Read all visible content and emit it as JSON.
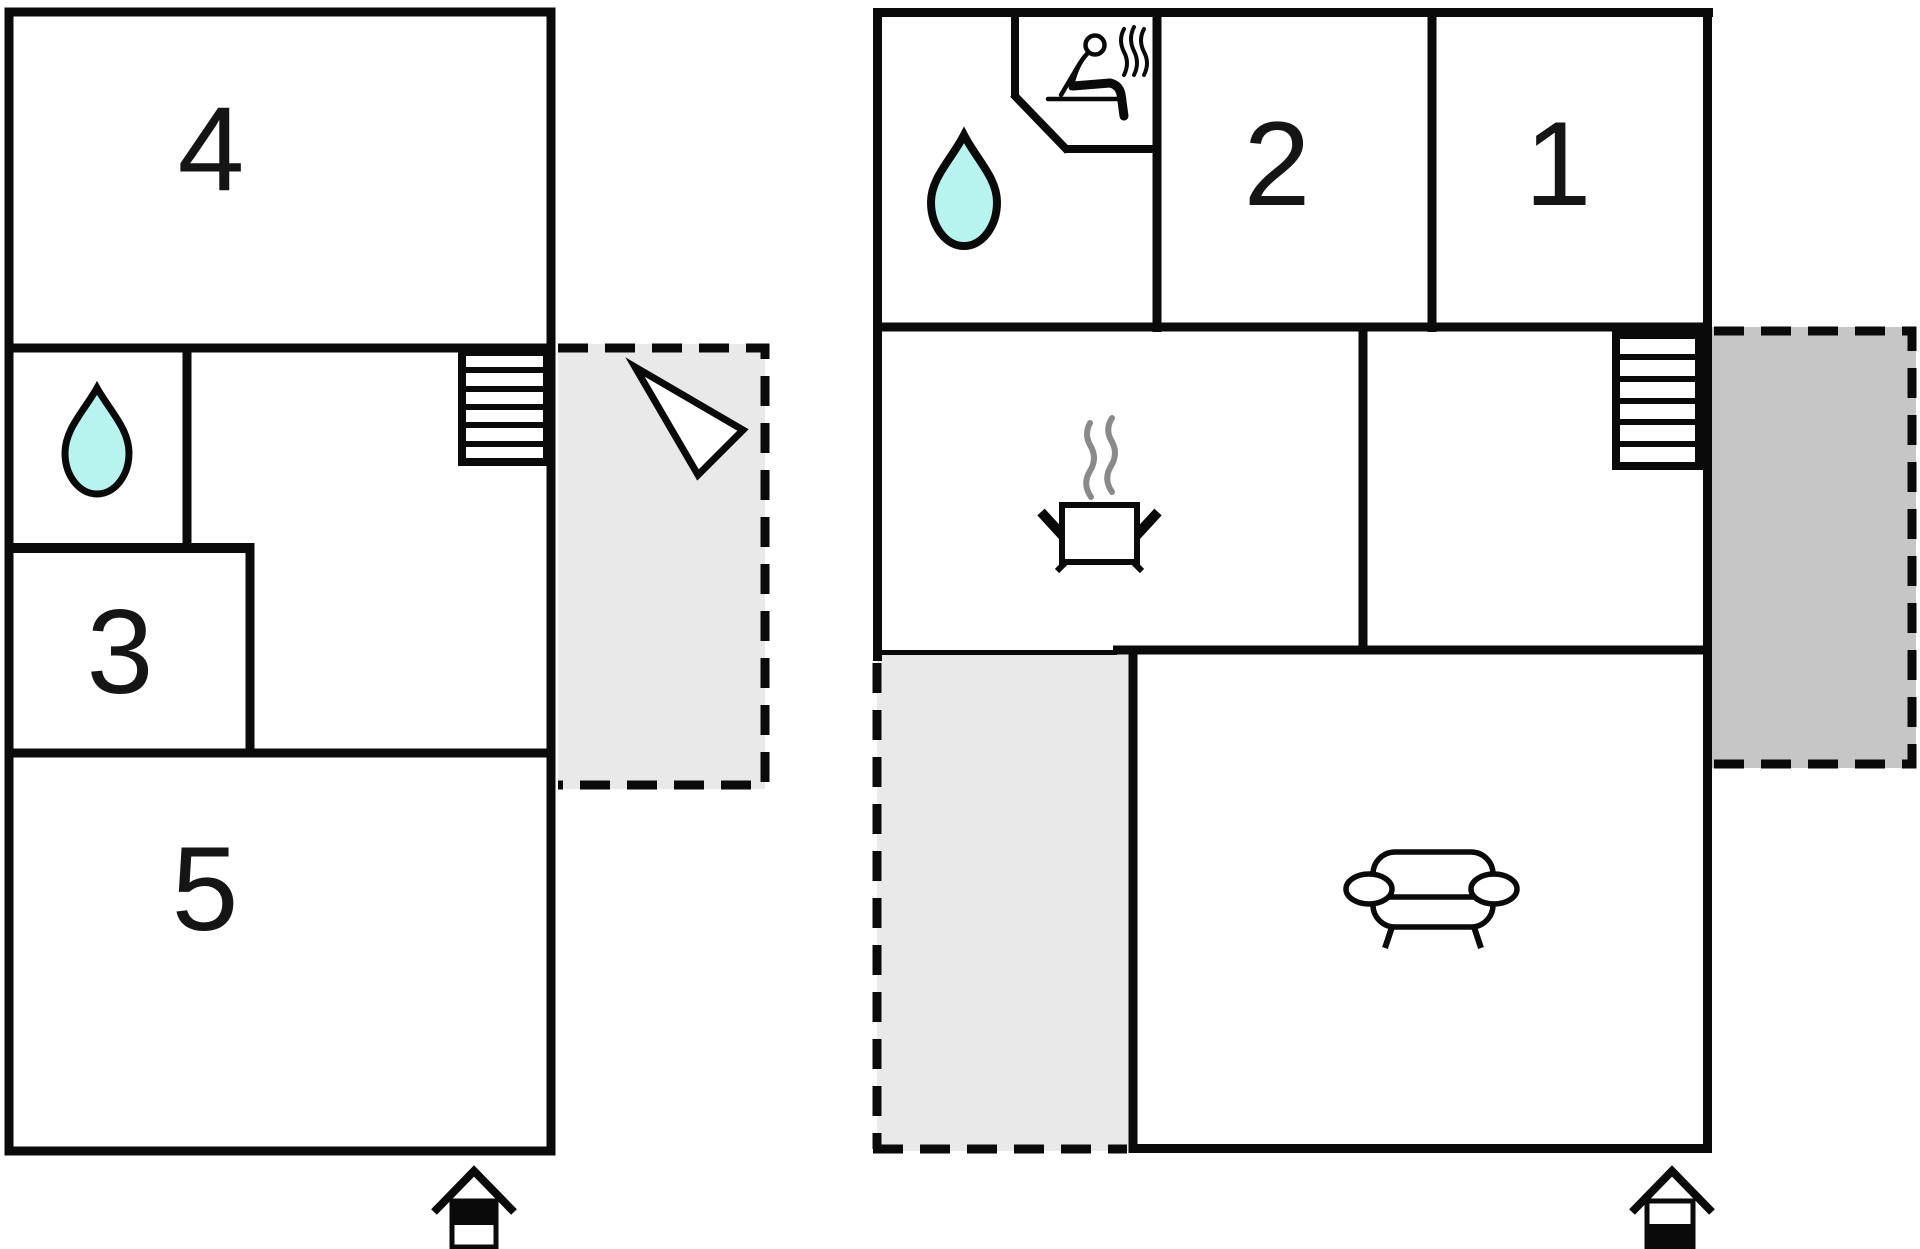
{
  "plan": {
    "kind": "floor-plan",
    "left_plan": {
      "rooms": [
        {
          "id": "room-4",
          "label": "4"
        },
        {
          "id": "room-3",
          "label": "3"
        },
        {
          "id": "room-5",
          "label": "5"
        }
      ],
      "icons": [
        "water-drop",
        "stairs",
        "direction-arrow",
        "house-entrance"
      ]
    },
    "right_plan": {
      "rooms": [
        {
          "id": "room-2",
          "label": "2"
        },
        {
          "id": "room-1",
          "label": "1"
        }
      ],
      "icons": [
        "water-drop",
        "sauna-person",
        "stairs",
        "cooking-pot",
        "sofa",
        "house-entrance"
      ]
    }
  },
  "colors": {
    "wall": "#0a0a0a",
    "label": "#151515",
    "water_fill": "#b7f3ef",
    "terrace_light": "#e9e9e9",
    "terrace_dark": "#c6c6c6",
    "steam_gray": "#8a8a8a",
    "background": "#ffffff"
  }
}
